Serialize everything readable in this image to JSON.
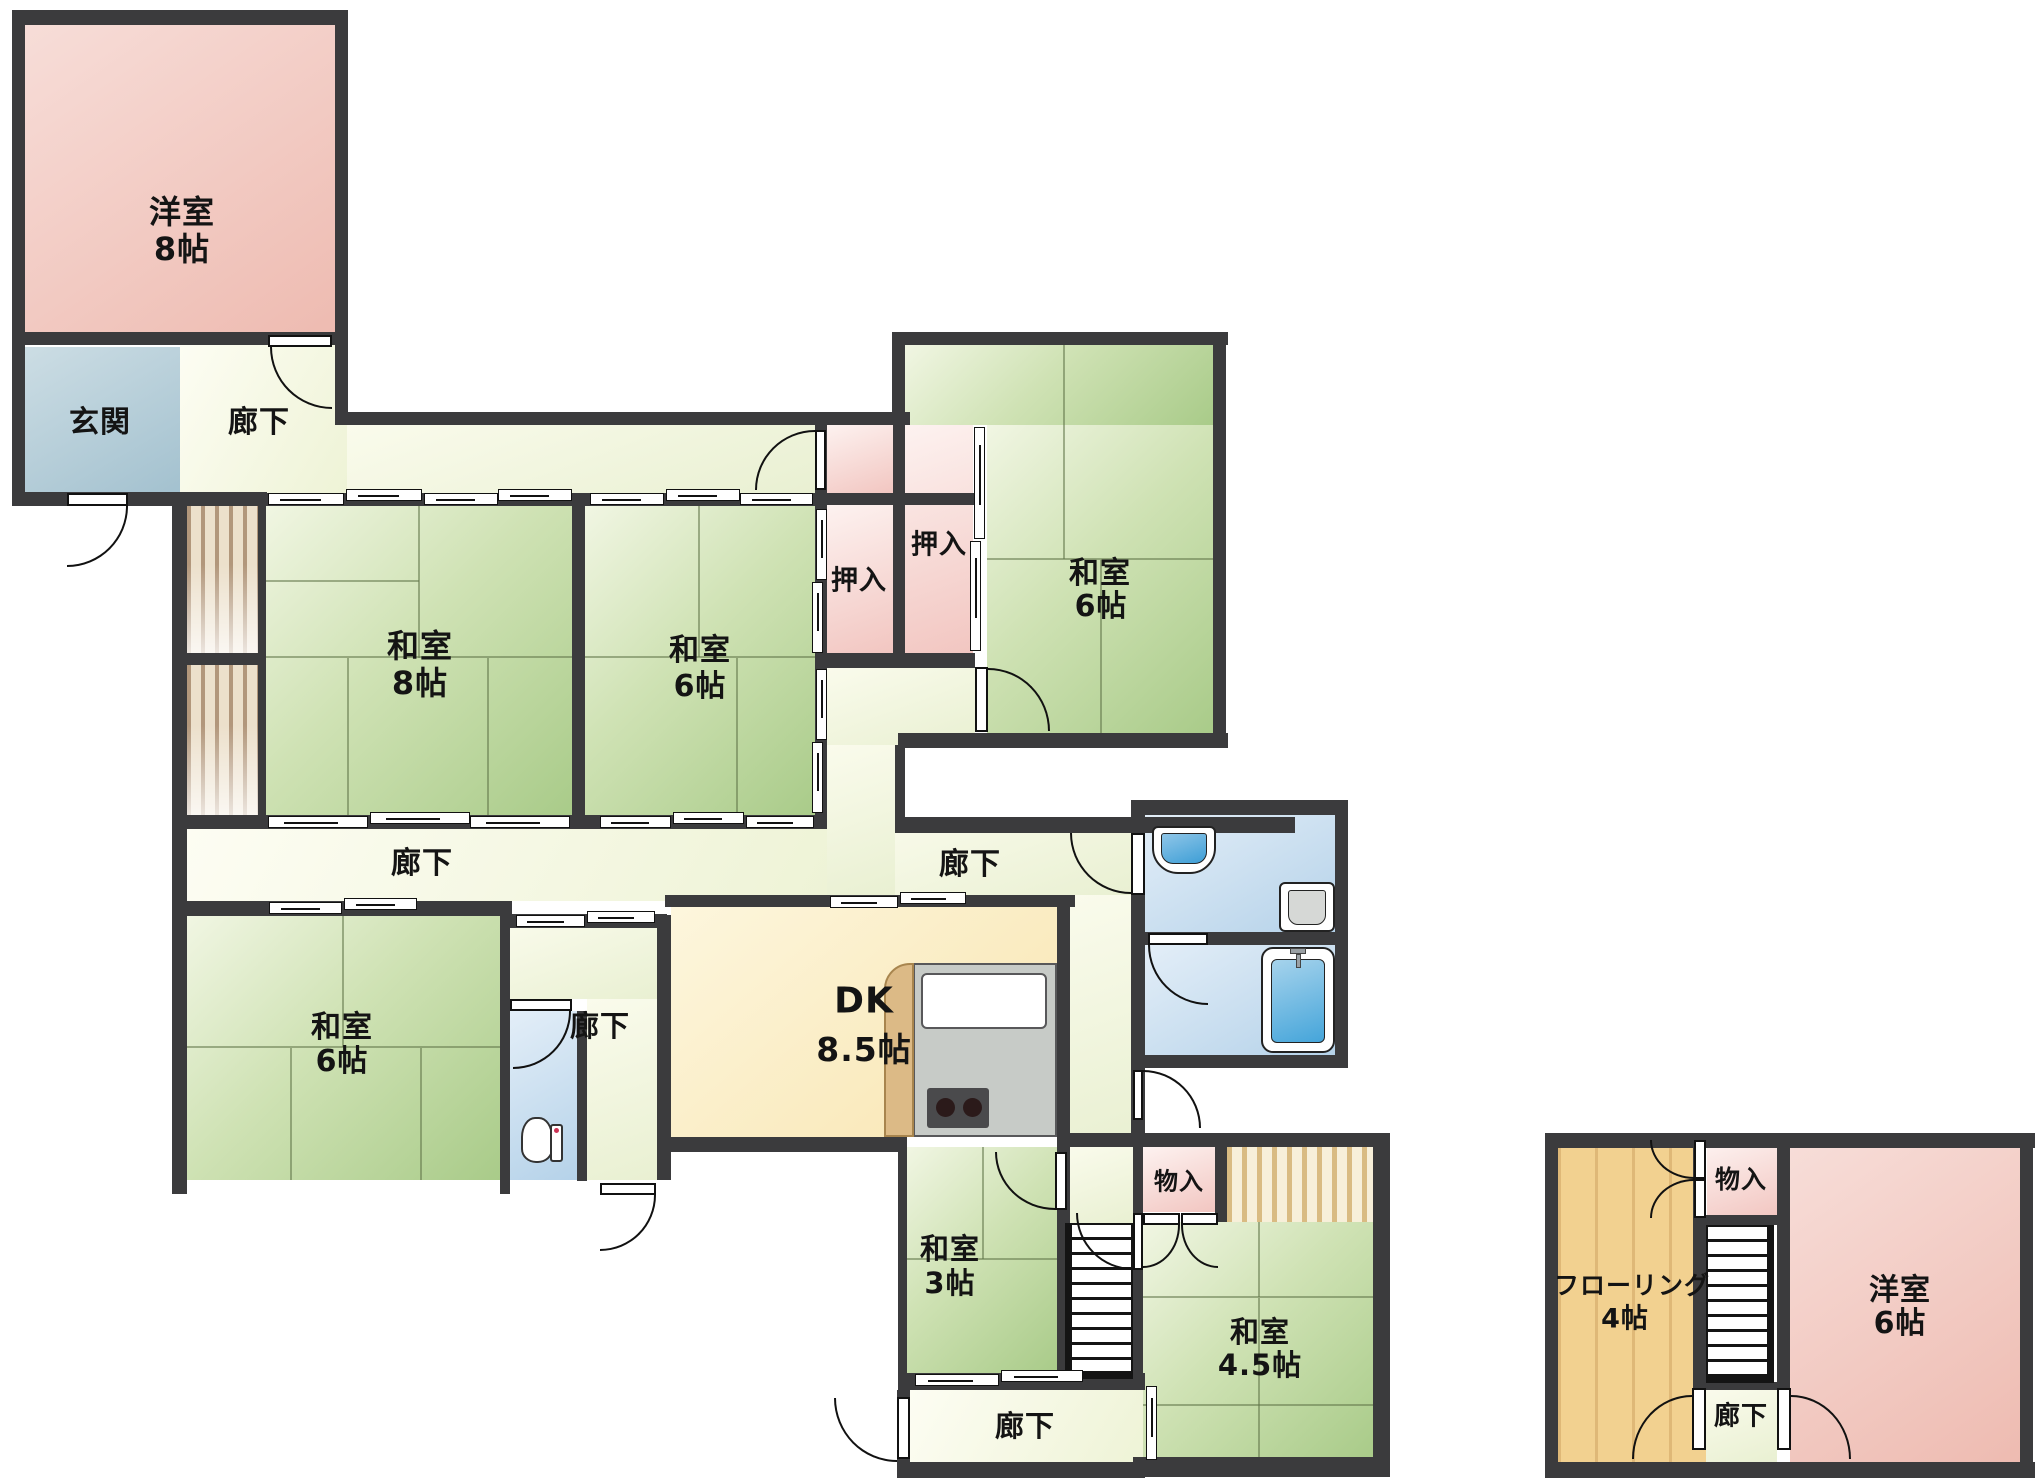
{
  "plan_type": "floor-plan",
  "colors": {
    "wall": "#3b3b3d",
    "western_room_pink": "#eebbb1",
    "closet_pink": "#f2c6c1",
    "tatami_green": "#a9cb89",
    "corridor_cream": "#eef3d6",
    "entrance_blue": "#a3c1cf",
    "wet_area_blue": "#b5d2e9",
    "dk_yellow": "#f8e5b0",
    "flooring_wood": "#f2d190"
  },
  "labels": {
    "yoshitsu8_name": "洋室",
    "yoshitsu8_size": "8帖",
    "genkan": "玄関",
    "rouka_top": "廊下",
    "rouka_left": "廊下",
    "rouka_right": "廊下",
    "rouka_mid": "廊下",
    "rouka_bottom": "廊下",
    "rouka_annex": "廊下",
    "washitsu8_name": "和室",
    "washitsu8_size": "8帖",
    "washitsu6mid_name": "和室",
    "washitsu6mid_size": "6帖",
    "washitsu6tr_name": "和室",
    "washitsu6tr_size": "6帖",
    "washitsu6bl_name": "和室",
    "washitsu6bl_size": "6帖",
    "oshiire_left": "押入",
    "oshiire_right": "押入",
    "dk_name": "DK",
    "dk_size": "8.5帖",
    "washitsu3_name": "和室",
    "washitsu3_size": "3帖",
    "monoire_mid": "物入",
    "monoire_annex": "物入",
    "washitsu45_name": "和室",
    "washitsu45_size": "4.5帖",
    "flooring_name": "フローリング",
    "flooring_size": "4帖",
    "yoshitsu6_name": "洋室",
    "yoshitsu6_size": "6帖"
  }
}
